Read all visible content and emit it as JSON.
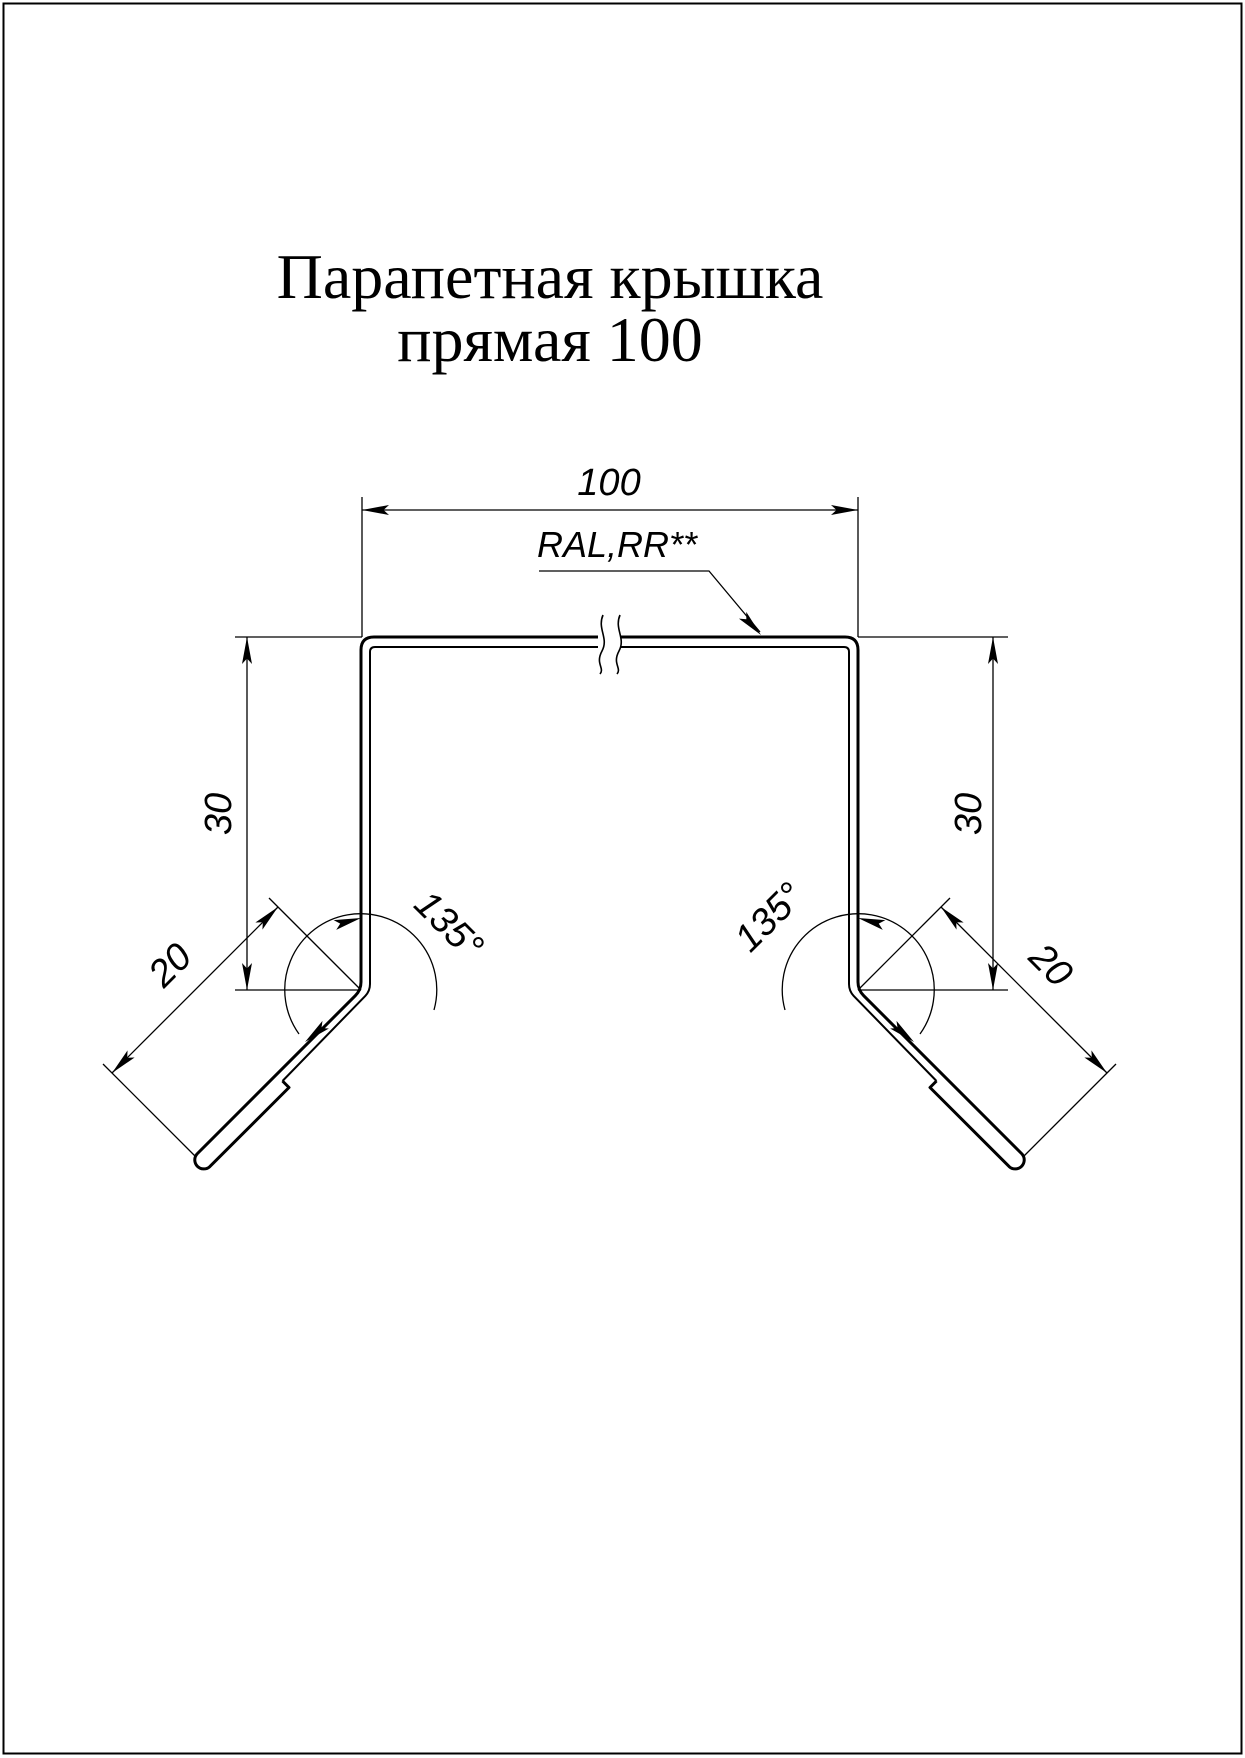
{
  "drawing": {
    "title_line1": "Парапетная крышка",
    "title_line2": "прямая 100",
    "dims": {
      "top_width": "100",
      "height_left": "30",
      "height_right": "30",
      "flange_left": "20",
      "flange_right": "20",
      "angle_left": "135°",
      "angle_right": "135°"
    },
    "labels": {
      "coating": "RAL,RR**"
    },
    "colors": {
      "line": "#000000",
      "background": "#ffffff"
    }
  }
}
